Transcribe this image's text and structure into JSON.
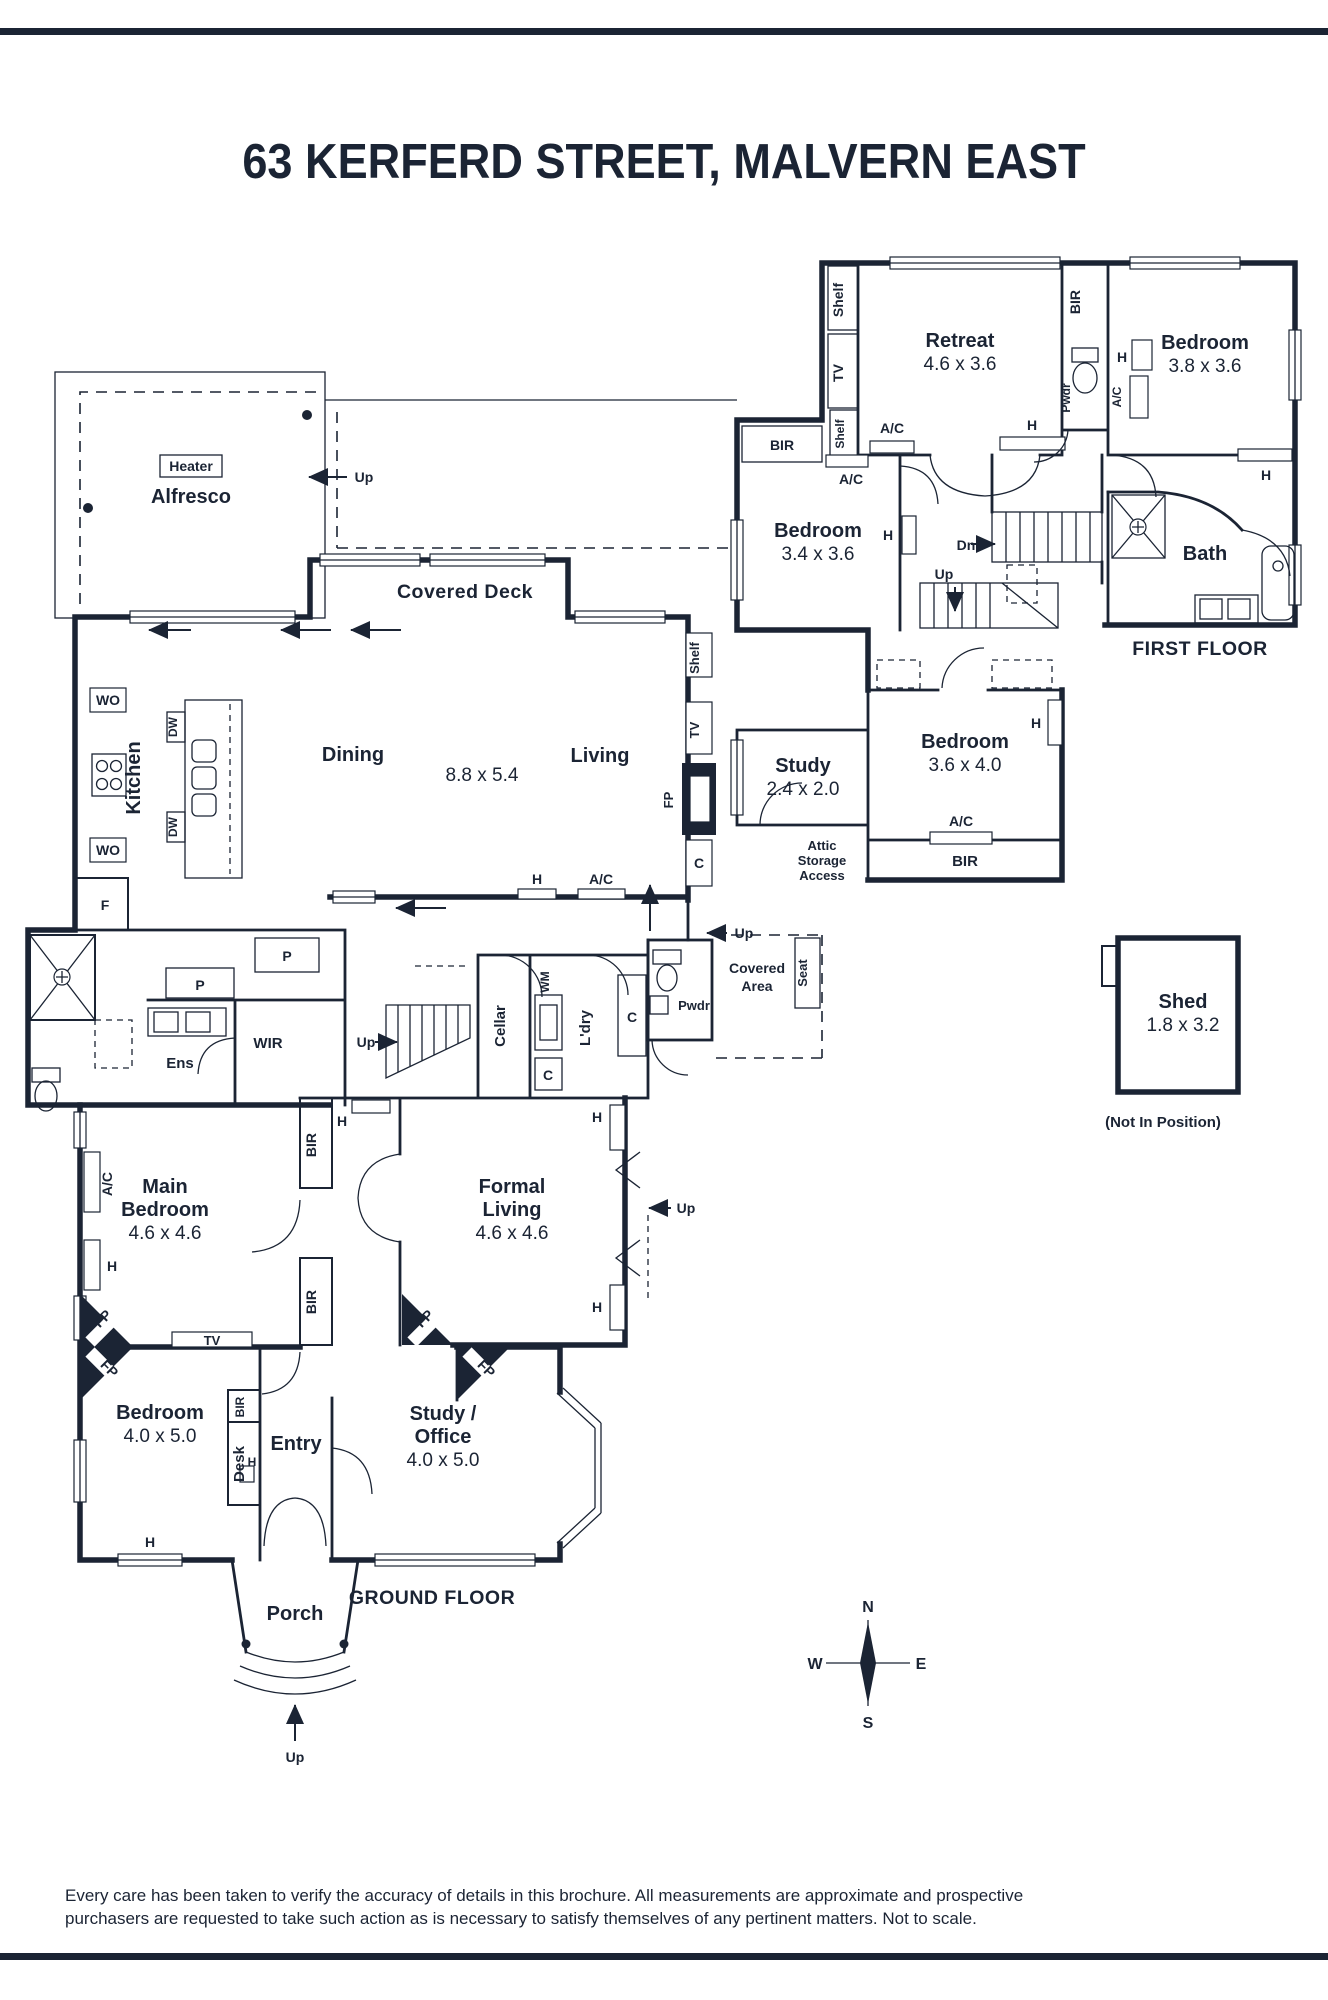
{
  "title": "63 KERFERD STREET, MALVERN EAST",
  "floor_titles": {
    "first": "FIRST FLOOR",
    "ground": "GROUND FLOOR"
  },
  "rooms": {
    "retreat": {
      "name": "Retreat",
      "dims": "4.6 x 3.6"
    },
    "bedroom_38": {
      "name": "Bedroom",
      "dims": "3.8 x 3.6"
    },
    "bedroom_34": {
      "name": "Bedroom",
      "dims": "3.4 x 3.6"
    },
    "bath": {
      "name": "Bath"
    },
    "bedroom_36": {
      "name": "Bedroom",
      "dims": "3.6 x 4.0"
    },
    "study_ff": {
      "name": "Study",
      "dims": "2.4 x 2.0"
    },
    "attic": {
      "line1": "Attic",
      "line2": "Storage",
      "line3": "Access"
    },
    "shed": {
      "name": "Shed",
      "dims": "1.8 x 3.2",
      "note": "(Not In Position)"
    },
    "alfresco": {
      "name": "Alfresco",
      "heater": "Heater"
    },
    "covered_deck": {
      "name": "Covered Deck"
    },
    "kitchen": {
      "name": "Kitchen"
    },
    "dining": {
      "name": "Dining"
    },
    "living": {
      "name": "Living"
    },
    "dining_living_dims": "8.8 x 5.4",
    "ens": {
      "name": "Ens"
    },
    "wir": {
      "name": "WIR"
    },
    "cellar": {
      "name": "Cellar"
    },
    "laundry": {
      "name": "L'dry"
    },
    "pwdr": {
      "name": "Pwdr"
    },
    "covered_area": {
      "line1": "Covered",
      "line2": "Area"
    },
    "seat": {
      "name": "Seat"
    },
    "main_bedroom": {
      "line1": "Main",
      "line2": "Bedroom",
      "dims": "4.6 x 4.6"
    },
    "formal_living": {
      "line1": "Formal",
      "line2": "Living",
      "dims": "4.6 x 4.6"
    },
    "bedroom_40": {
      "name": "Bedroom",
      "dims": "4.0 x 5.0"
    },
    "entry": {
      "name": "Entry"
    },
    "study_office": {
      "line1": "Study /",
      "line2": "Office",
      "dims": "4.0 x 5.0"
    },
    "porch": {
      "name": "Porch"
    }
  },
  "fixtures": {
    "bir": "BIR",
    "shelf": "Shelf",
    "tv": "TV",
    "ac": "A/C",
    "h": "H",
    "fp": "FP",
    "c": "C",
    "p": "P",
    "f": "F",
    "wo": "WO",
    "dw": "DW",
    "wm": "WM",
    "desk": "Desk",
    "up": "Up",
    "dn": "Dn"
  },
  "compass": {
    "n": "N",
    "e": "E",
    "s": "S",
    "w": "W"
  },
  "disclaimer": {
    "line1": "Every care has been taken to verify the accuracy of details in this brochure. All measurements are approximate and prospective",
    "line2": "purchasers are requested to take such action as is necessary to satisfy themselves of any pertinent matters. Not to scale."
  },
  "colors": {
    "ink": "#1b2434",
    "bg": "#ffffff"
  }
}
